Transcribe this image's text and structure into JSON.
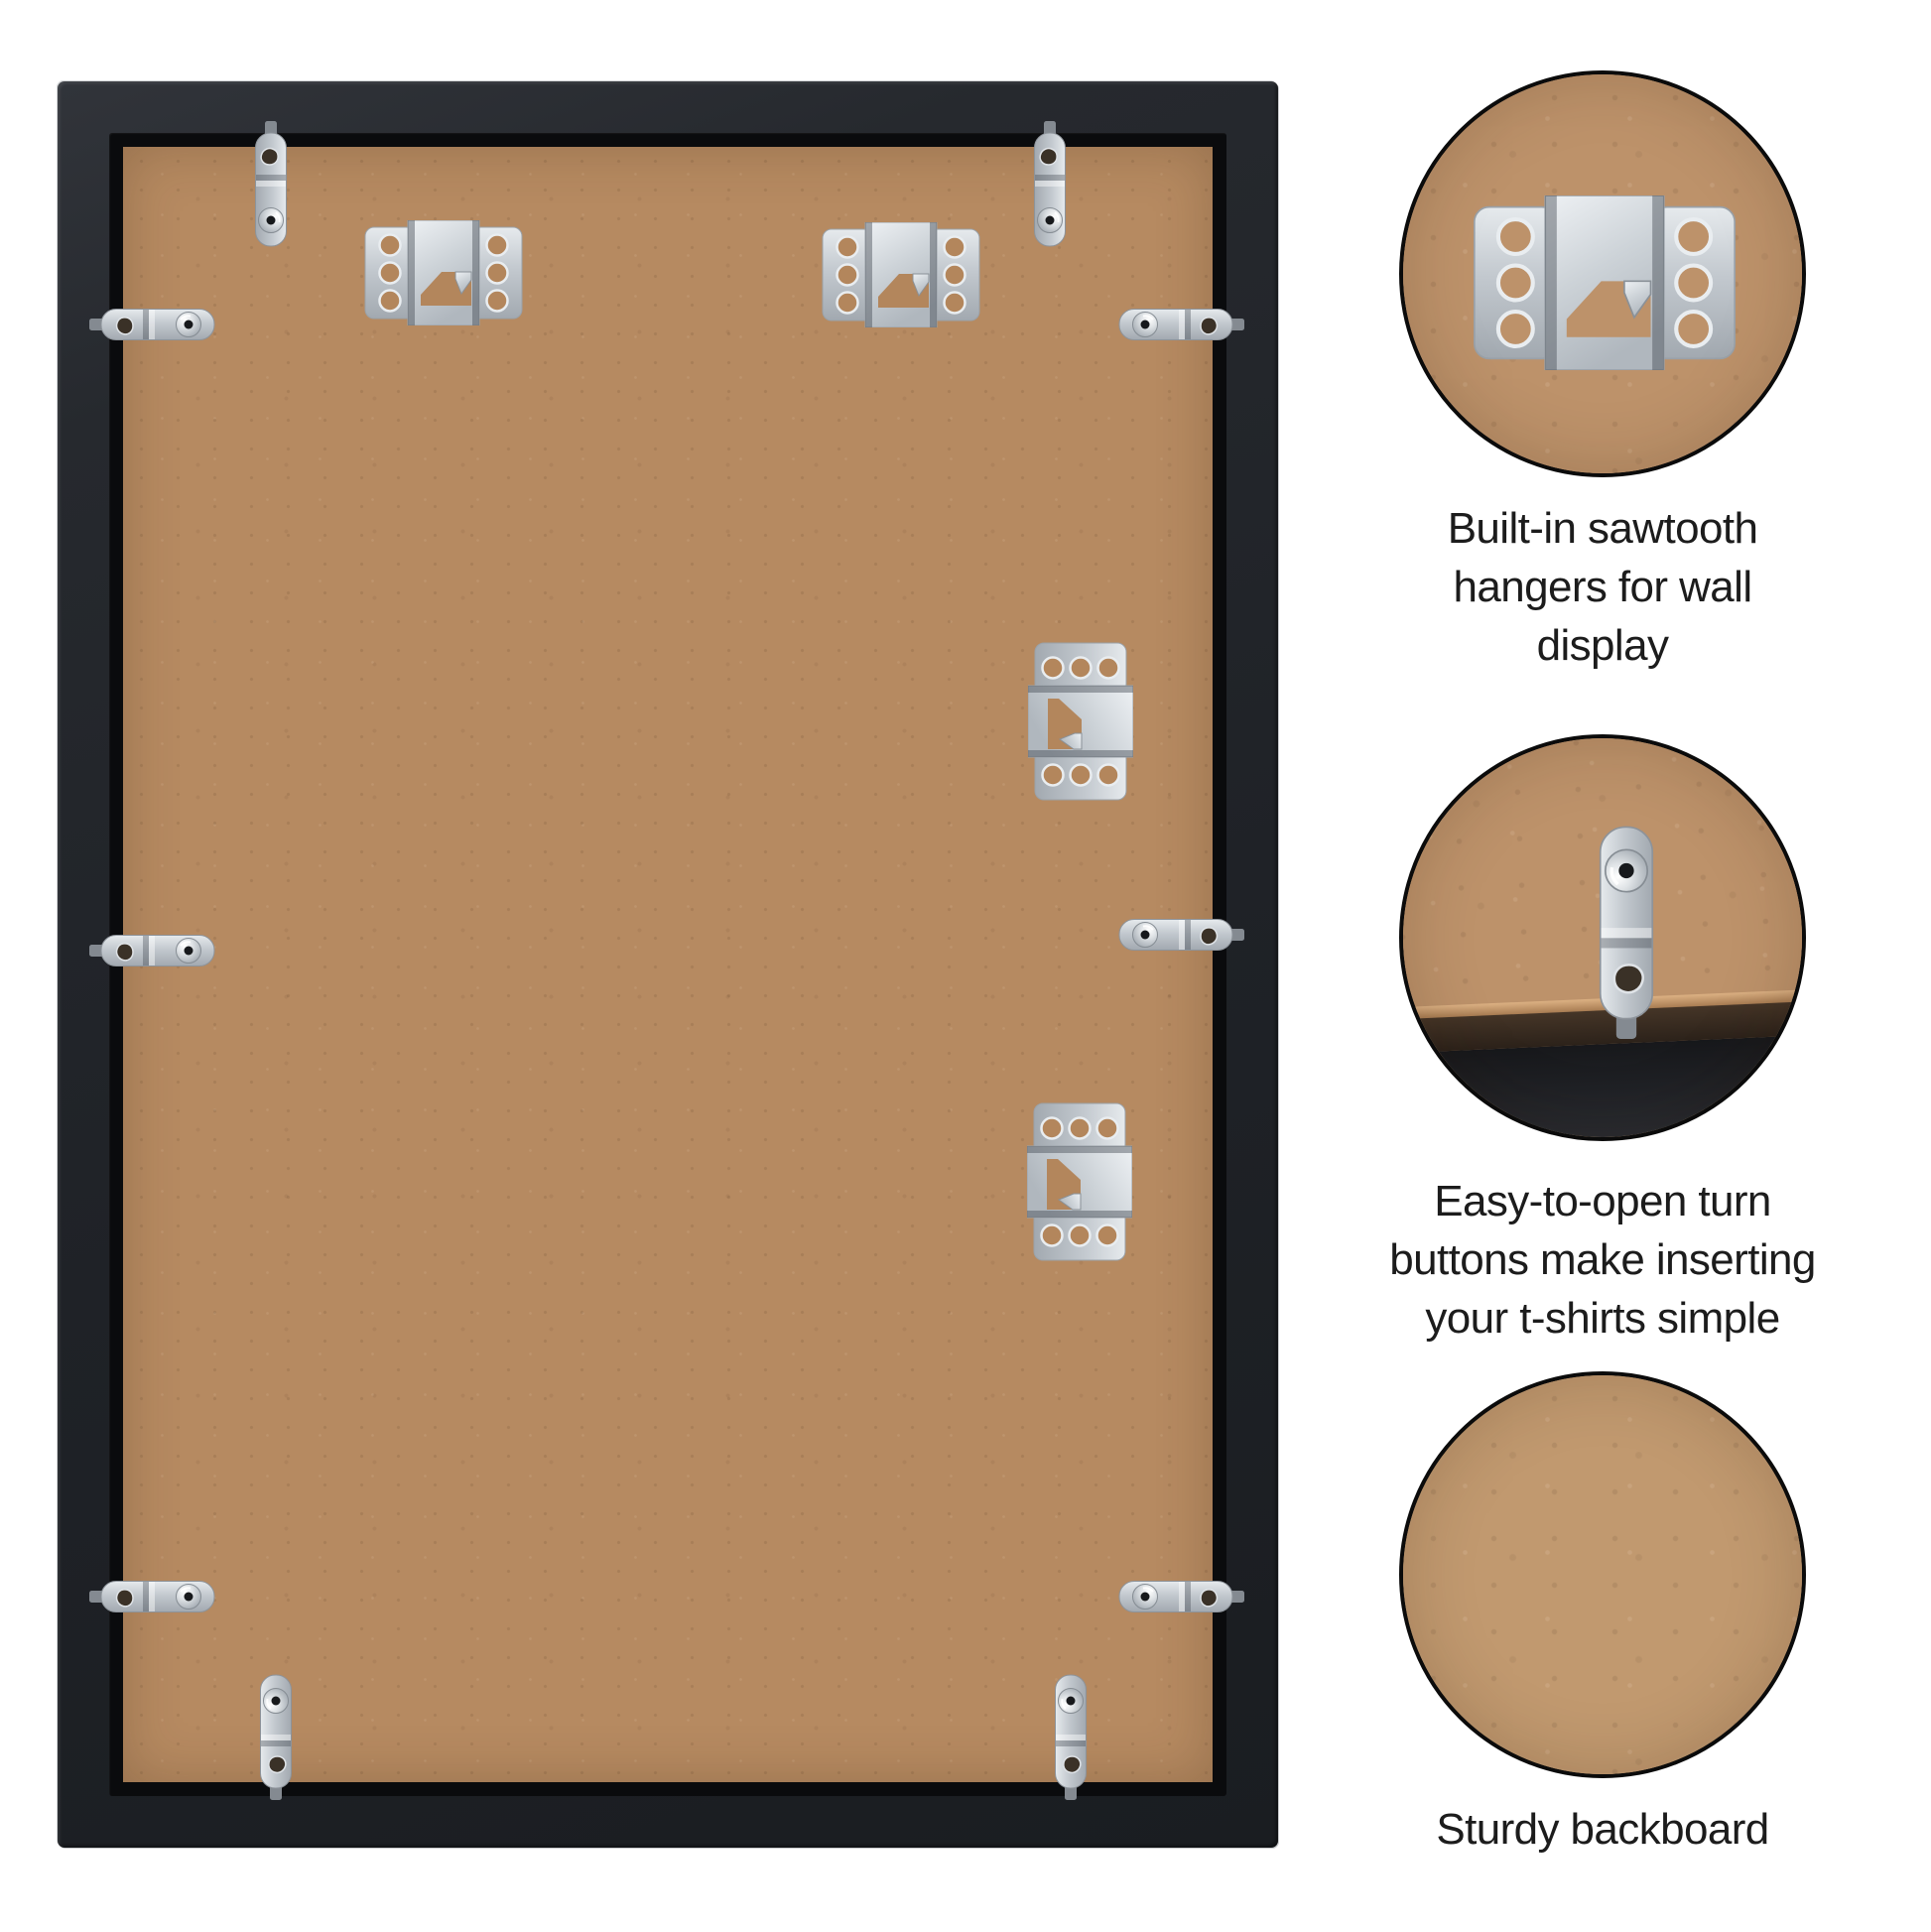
{
  "colors": {
    "background": "#ffffff",
    "frame_black": "#202329",
    "frame_lip": "#0a0b0d",
    "backboard_brown": "#b68a61",
    "closeup_brown": "#bd926a",
    "closeup_light_brown": "#c1996f",
    "metal_silver": "#c9ced4",
    "caption_text": "#1c1c1c",
    "circle_outline": "#0b0b0b"
  },
  "frame_back": {
    "sawtooth_hanger_count": 4,
    "turn_button_count": 10
  },
  "callouts": [
    {
      "photo": "sawtooth-hanger-closeup",
      "caption_lines": [
        "Built-in sawtooth",
        "hangers for wall",
        "display"
      ]
    },
    {
      "photo": "turn-button-closeup",
      "caption_lines": [
        "Easy-to-open turn",
        "buttons make inserting",
        "your t-shirts simple"
      ]
    },
    {
      "photo": "backboard-closeup",
      "caption_lines": [
        "Sturdy backboard"
      ]
    }
  ]
}
